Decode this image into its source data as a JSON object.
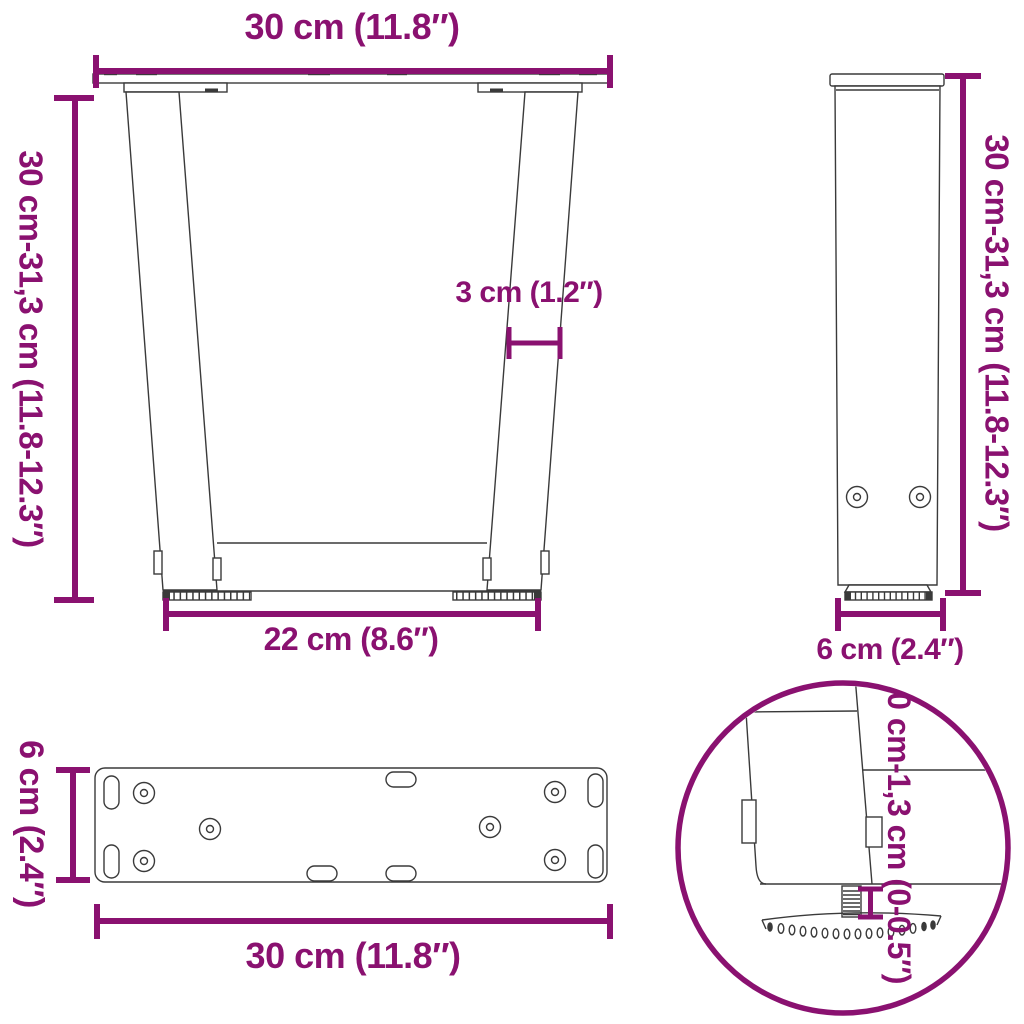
{
  "title": "Table leg dimension diagram",
  "colors": {
    "accent": "#8A1170",
    "line": "#3A3A3A"
  },
  "labels": {
    "front_width_top": "30 cm (11.8″)",
    "front_height": "30 cm-31,3 cm (11.8-12.3″)",
    "leg_thickness": "3 cm (1.2″)",
    "front_width_bottom": "22 cm (8.6″)",
    "side_height": "30 cm-31,3 cm (11.8-12.3″)",
    "side_width": "6 cm (2.4″)",
    "plate_depth": "6 cm (2.4″)",
    "plate_width": "30 cm (11.8″)",
    "foot_adjust_range": "0 cm-1,3 cm (0-0.5″)"
  }
}
